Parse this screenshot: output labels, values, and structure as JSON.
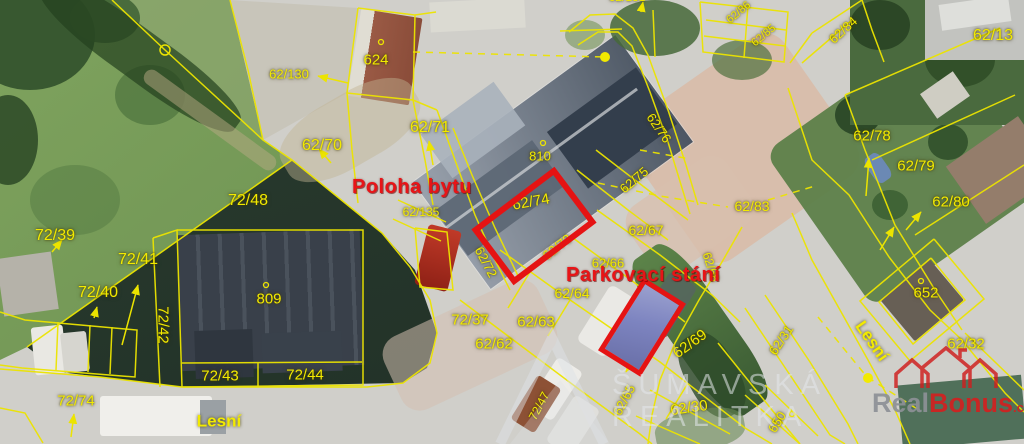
{
  "title": "Cadastral aerial map with apartment and parking markers",
  "annotations": {
    "apartment_label": "Poloha bytu",
    "parking_label": "Parkovací stání"
  },
  "street_labels": [
    {
      "text": "Lesní",
      "x": 219,
      "y": 421,
      "rot": 0,
      "size": 17
    },
    {
      "text": "Lesní",
      "x": 872,
      "y": 341,
      "rot": 55,
      "size": 17
    }
  ],
  "parcel_labels": [
    {
      "text": "62/130",
      "x": 289,
      "y": 74,
      "rot": 0,
      "size": 13
    },
    {
      "text": "624",
      "x": 376,
      "y": 60,
      "rot": 0,
      "size": 15
    },
    {
      "text": "62/71",
      "x": 430,
      "y": 128,
      "rot": 0,
      "size": 16
    },
    {
      "text": "62/70",
      "x": 322,
      "y": 146,
      "rot": 0,
      "size": 16
    },
    {
      "text": "72/48",
      "x": 248,
      "y": 201,
      "rot": 0,
      "size": 16
    },
    {
      "text": "72/39",
      "x": 55,
      "y": 236,
      "rot": 0,
      "size": 16
    },
    {
      "text": "72/41",
      "x": 138,
      "y": 260,
      "rot": 0,
      "size": 16
    },
    {
      "text": "72/40",
      "x": 98,
      "y": 293,
      "rot": 0,
      "size": 16
    },
    {
      "text": "72/42",
      "x": 163,
      "y": 325,
      "rot": 90,
      "size": 15
    },
    {
      "text": "809",
      "x": 269,
      "y": 299,
      "rot": 0,
      "size": 15
    },
    {
      "text": "72/43",
      "x": 220,
      "y": 376,
      "rot": 0,
      "size": 15
    },
    {
      "text": "72/44",
      "x": 305,
      "y": 375,
      "rot": 0,
      "size": 15
    },
    {
      "text": "72/74",
      "x": 76,
      "y": 401,
      "rot": 0,
      "size": 15
    },
    {
      "text": "62/135",
      "x": 421,
      "y": 212,
      "rot": 0,
      "size": 12
    },
    {
      "text": "810",
      "x": 540,
      "y": 156,
      "rot": 0,
      "size": 13
    },
    {
      "text": "62/74",
      "x": 531,
      "y": 202,
      "rot": -10,
      "size": 15
    },
    {
      "text": "62/72",
      "x": 486,
      "y": 262,
      "rot": 62,
      "size": 13
    },
    {
      "text": "62/73",
      "x": 557,
      "y": 247,
      "rot": -38,
      "size": 13
    },
    {
      "text": "62/76",
      "x": 659,
      "y": 128,
      "rot": 55,
      "size": 13
    },
    {
      "text": "62/75",
      "x": 634,
      "y": 180,
      "rot": -40,
      "size": 13
    },
    {
      "text": "62/83",
      "x": 752,
      "y": 206,
      "rot": 0,
      "size": 14
    },
    {
      "text": "62/67",
      "x": 646,
      "y": 230,
      "rot": 0,
      "size": 14
    },
    {
      "text": "62/66",
      "x": 608,
      "y": 263,
      "rot": 0,
      "size": 13
    },
    {
      "text": "62/64",
      "x": 572,
      "y": 293,
      "rot": 0,
      "size": 14
    },
    {
      "text": "72/37",
      "x": 470,
      "y": 320,
      "rot": 0,
      "size": 15
    },
    {
      "text": "62/63",
      "x": 536,
      "y": 322,
      "rot": 0,
      "size": 15
    },
    {
      "text": "62/62",
      "x": 494,
      "y": 344,
      "rot": 0,
      "size": 15
    },
    {
      "text": "62/68",
      "x": 711,
      "y": 267,
      "rot": 72,
      "size": 12
    },
    {
      "text": "62/69",
      "x": 690,
      "y": 344,
      "rot": -36,
      "size": 15
    },
    {
      "text": "62/65",
      "x": 624,
      "y": 400,
      "rot": -62,
      "size": 13
    },
    {
      "text": "62/30",
      "x": 689,
      "y": 408,
      "rot": -8,
      "size": 15
    },
    {
      "text": "650",
      "x": 777,
      "y": 422,
      "rot": -58,
      "size": 13
    },
    {
      "text": "72/47",
      "x": 539,
      "y": 406,
      "rot": -62,
      "size": 12
    },
    {
      "text": "62/31",
      "x": 781,
      "y": 340,
      "rot": -56,
      "size": 13
    },
    {
      "text": "62/13",
      "x": 993,
      "y": 36,
      "rot": 0,
      "size": 16
    },
    {
      "text": "62/78",
      "x": 872,
      "y": 136,
      "rot": 0,
      "size": 15
    },
    {
      "text": "62/79",
      "x": 916,
      "y": 166,
      "rot": 0,
      "size": 15
    },
    {
      "text": "62/80",
      "x": 951,
      "y": 202,
      "rot": 0,
      "size": 15
    },
    {
      "text": "652",
      "x": 926,
      "y": 293,
      "rot": 0,
      "size": 15
    },
    {
      "text": "62/32",
      "x": 966,
      "y": 344,
      "rot": 0,
      "size": 15
    },
    {
      "text": "62/84",
      "x": 843,
      "y": 30,
      "rot": -42,
      "size": 13
    },
    {
      "text": "62/85",
      "x": 764,
      "y": 36,
      "rot": -40,
      "size": 11
    },
    {
      "text": "62/86",
      "x": 739,
      "y": 13,
      "rot": -40,
      "size": 11
    },
    {
      "text": "62/131",
      "x": 627,
      "y": -3,
      "rot": 0,
      "size": 12
    }
  ],
  "watermarks": {
    "agency_line1": "ŠUMAVSKÁ",
    "agency_line2": "REALITKA",
    "brand_gray": "Real",
    "brand_red": "Bonus",
    "brand_tld": ".cz"
  },
  "colors": {
    "cadastral_yellow": "#f2ea00",
    "annotation_red": "#e81417",
    "marker_red": "#e51313",
    "parking_fill_blue": "#7d84c0"
  }
}
